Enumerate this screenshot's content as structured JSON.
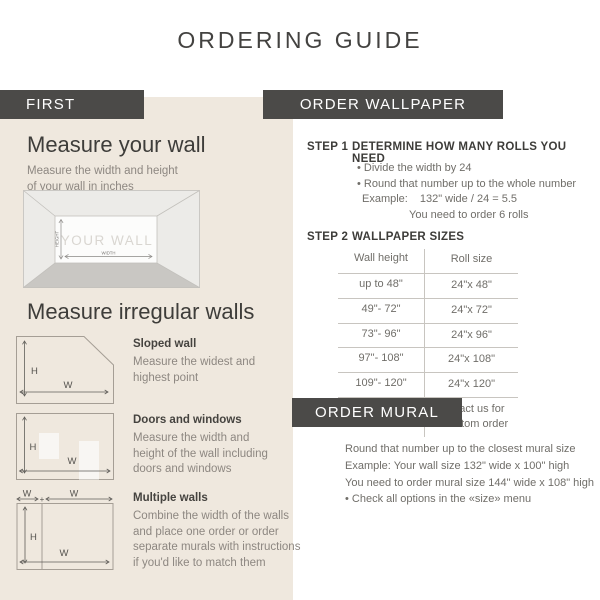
{
  "page": {
    "title": "ORDERING GUIDE"
  },
  "first": {
    "bar_label": "FIRST",
    "measure_wall": {
      "heading": "Measure your wall",
      "subtext": "Measure the width and height\nof your wall in inches",
      "diagram": {
        "wall_label": "YOUR WALL",
        "height_label": "HEIGHT",
        "width_label": "WIDTH"
      }
    },
    "irregular": {
      "heading": "Measure irregular walls",
      "items": [
        {
          "title": "Sloped wall",
          "desc": "Measure the widest and\nhighest point",
          "h": "H",
          "w": "W"
        },
        {
          "title": "Doors and windows",
          "desc": "Measure the width and\nheight of the wall including\ndoors and windows",
          "h": "H",
          "w": "W"
        },
        {
          "title": "Multiple walls",
          "desc": "Combine the width of the walls\nand place one order or order\nseparate murals with instructions\nif you'd like to match them",
          "h": "H",
          "w": "W",
          "w2": "W",
          "plus": "+"
        }
      ]
    }
  },
  "order_wallpaper": {
    "bar_label": "ORDER WALLPAPER",
    "step1": {
      "label": "STEP 1",
      "heading": "DETERMINE HOW MANY ROLLS YOU NEED",
      "bullets": [
        "• Divide the width by 24",
        "• Round that number up to the whole number"
      ],
      "example_label": "Example:",
      "example_value": "132\" wide / 24 = 5.5",
      "example_result": "You need to order 6 rolls"
    },
    "step2": {
      "label": "STEP 2",
      "heading": "WALLPAPER SIZES",
      "table": {
        "headers": [
          "Wall height",
          "Roll size"
        ],
        "rows": [
          [
            "up to 48\"",
            "24\"x 48\""
          ],
          [
            "49\"- 72\"",
            "24\"x 72\""
          ],
          [
            "73\"- 96\"",
            "24\"x 96\""
          ],
          [
            "97\"- 108\"",
            "24\"x 108\""
          ],
          [
            "109\"- 120\"",
            "24\"x 120\""
          ],
          [
            "more than 120\"",
            "contact us for\na custom order"
          ]
        ]
      }
    }
  },
  "order_mural": {
    "bar_label": "ORDER MURAL",
    "lines": [
      "Round that number up to the closest mural size",
      "Example: Your wall size 132\" wide x 100\" high",
      "You need to order mural size 144\" wide x 108\" high",
      "• Check all options in the «size» menu"
    ]
  },
  "colors": {
    "panel_beige": "#efe8de",
    "bar_dark": "#4b4a48",
    "text_dark": "#3e3d3a",
    "text_gray": "#8d8781",
    "table_line": "#c8c5c0"
  }
}
